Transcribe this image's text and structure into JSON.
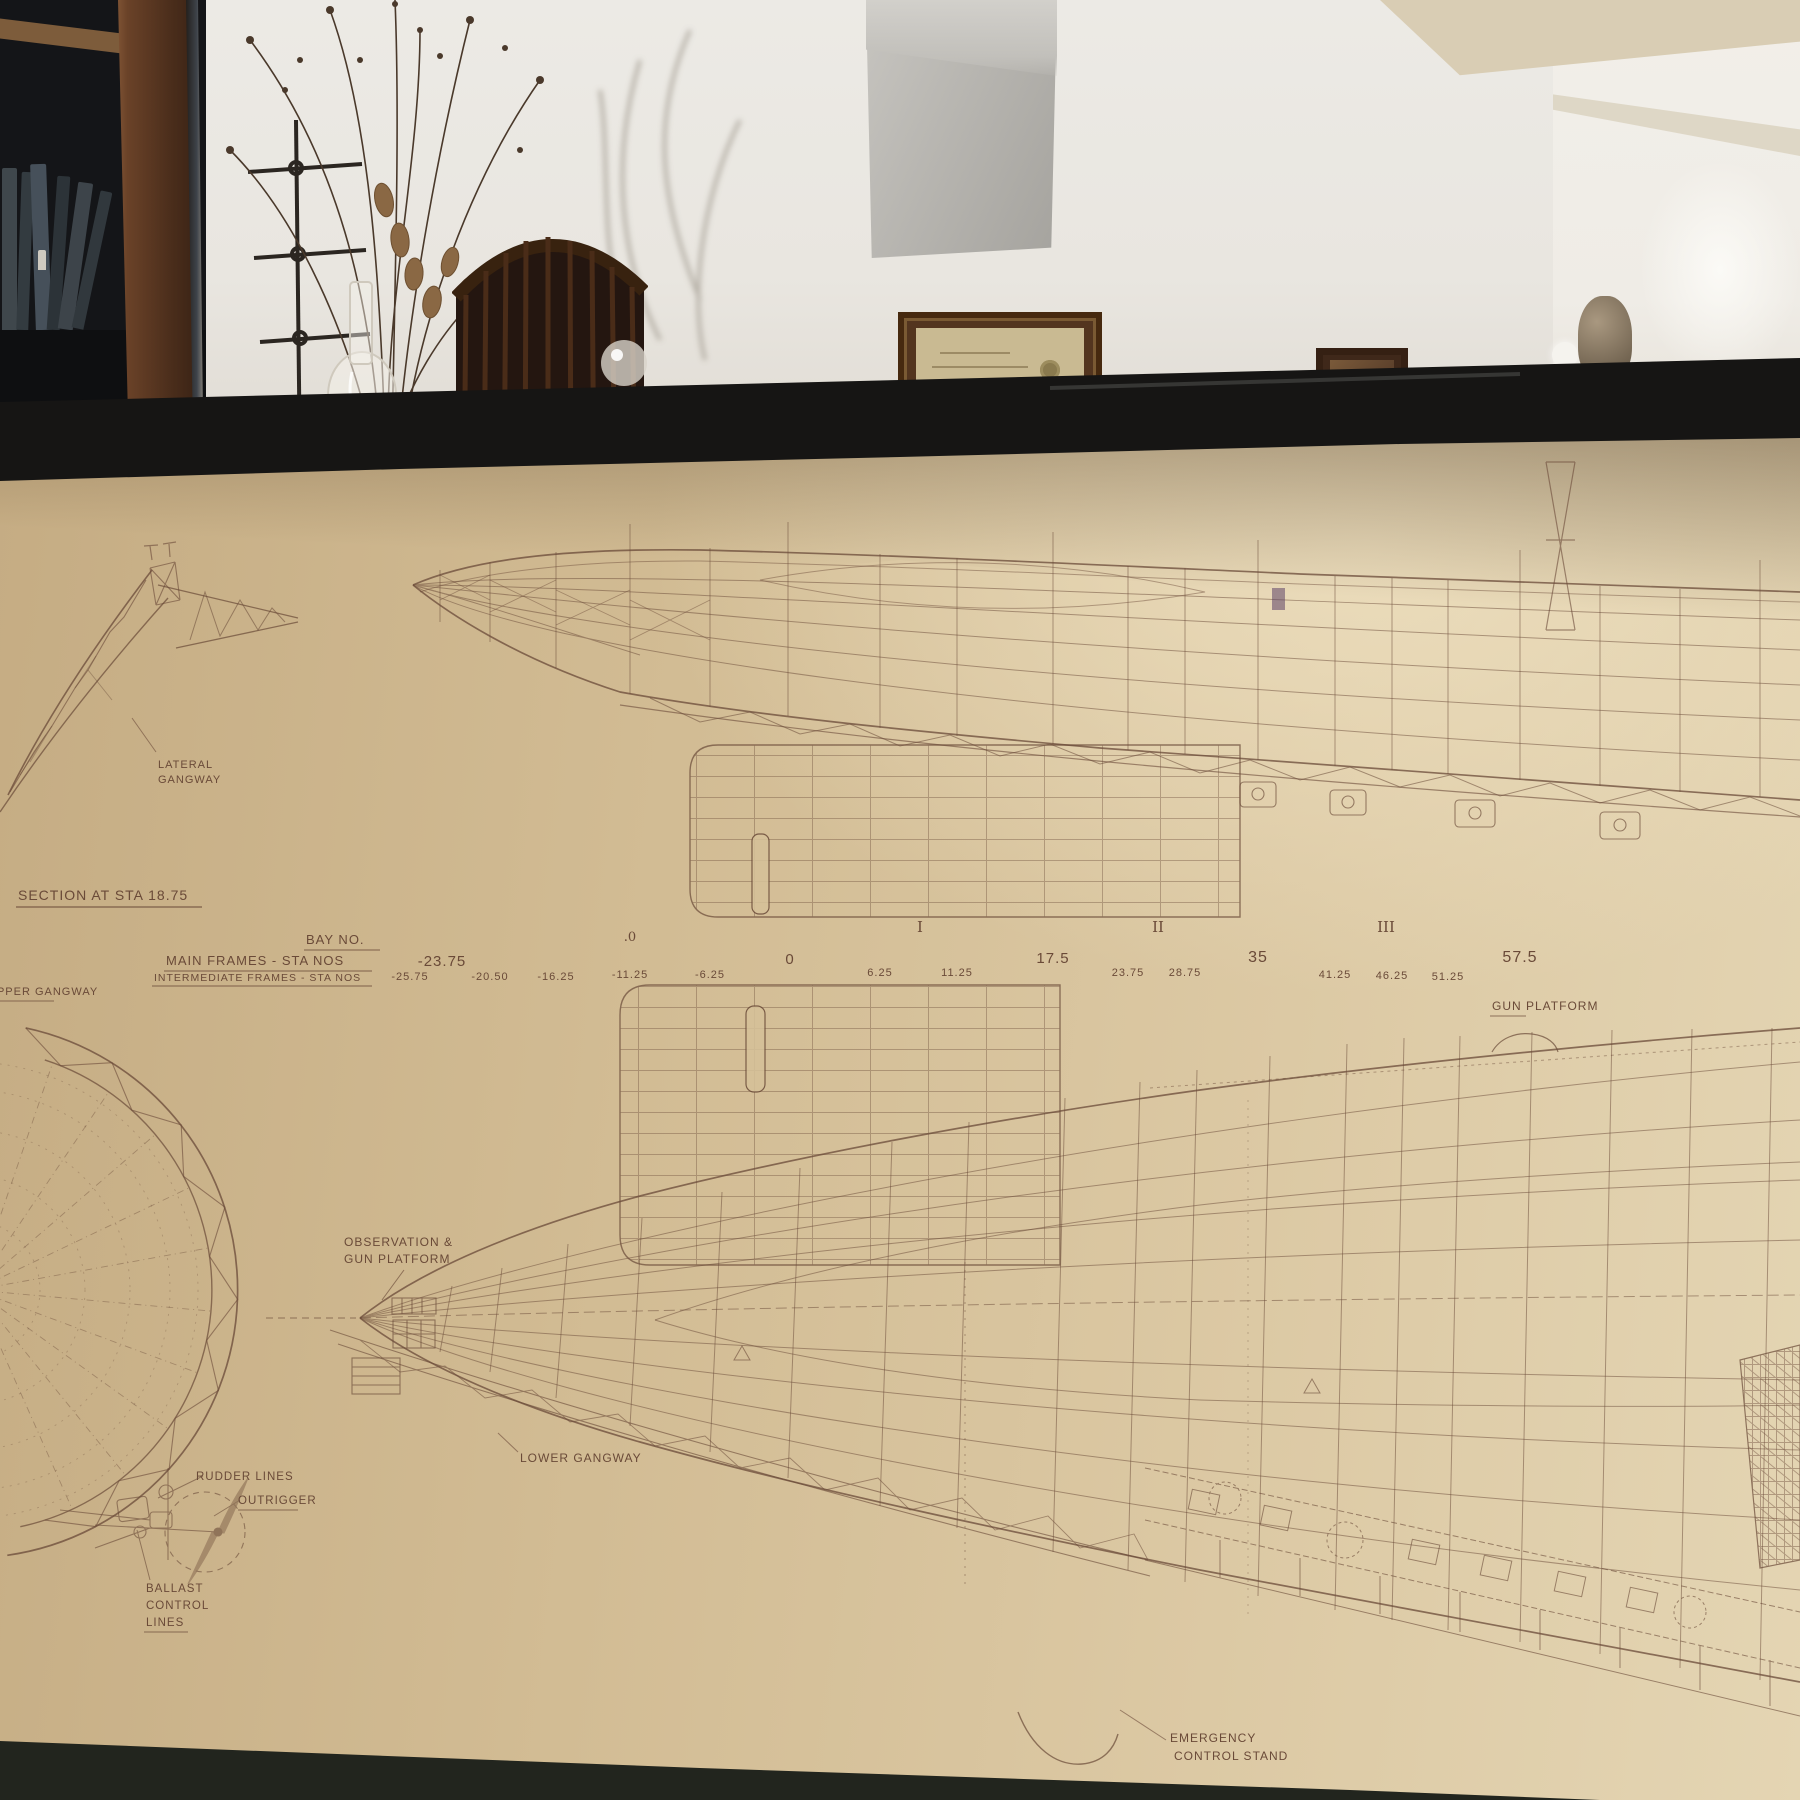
{
  "blueprint": {
    "section_title": "SECTION AT STA 18.75",
    "labels": {
      "lateral_gangway": [
        "LATERAL",
        "GANGWAY"
      ],
      "upper_gangway": "UPPER GANGWAY",
      "gun_platform": "GUN PLATFORM",
      "observation_gun_platform": [
        "OBSERVATION &",
        "GUN PLATFORM"
      ],
      "lower_gangway": "LOWER GANGWAY",
      "rudder_lines": "RUDDER LINES",
      "outrigger": "OUTRIGGER",
      "ballast_control_lines": [
        "BALLAST",
        "CONTROL",
        "LINES"
      ],
      "emergency_control_stand": [
        "EMERGENCY",
        "CONTROL  STAND"
      ]
    },
    "station_table": {
      "bay_header": "BAY  NO.",
      "main_header": "MAIN  FRAMES - STA  NOS",
      "intermediate_header": "INTERMEDIATE  FRAMES - STA  NOS",
      "bays": [
        ".0",
        "I",
        "II",
        "III"
      ],
      "main_stations": [
        "-23.75",
        "0",
        "17.5",
        "35",
        "57.5"
      ],
      "intermediate_stations": [
        "-25.75",
        "-20.50",
        "-16.25",
        "-11.25",
        "-6.25",
        "6.25",
        "11.25",
        "23.75",
        "28.75",
        "41.25",
        "46.25",
        "51.25"
      ]
    },
    "ink_color": "#6a4a38",
    "paper_color": "#d7c29b"
  },
  "scene": {
    "frame_color": "#161514",
    "wall_color": "#e8e5df",
    "niche_color": "#b5b2ad",
    "wood_color": "#5e3b24"
  }
}
